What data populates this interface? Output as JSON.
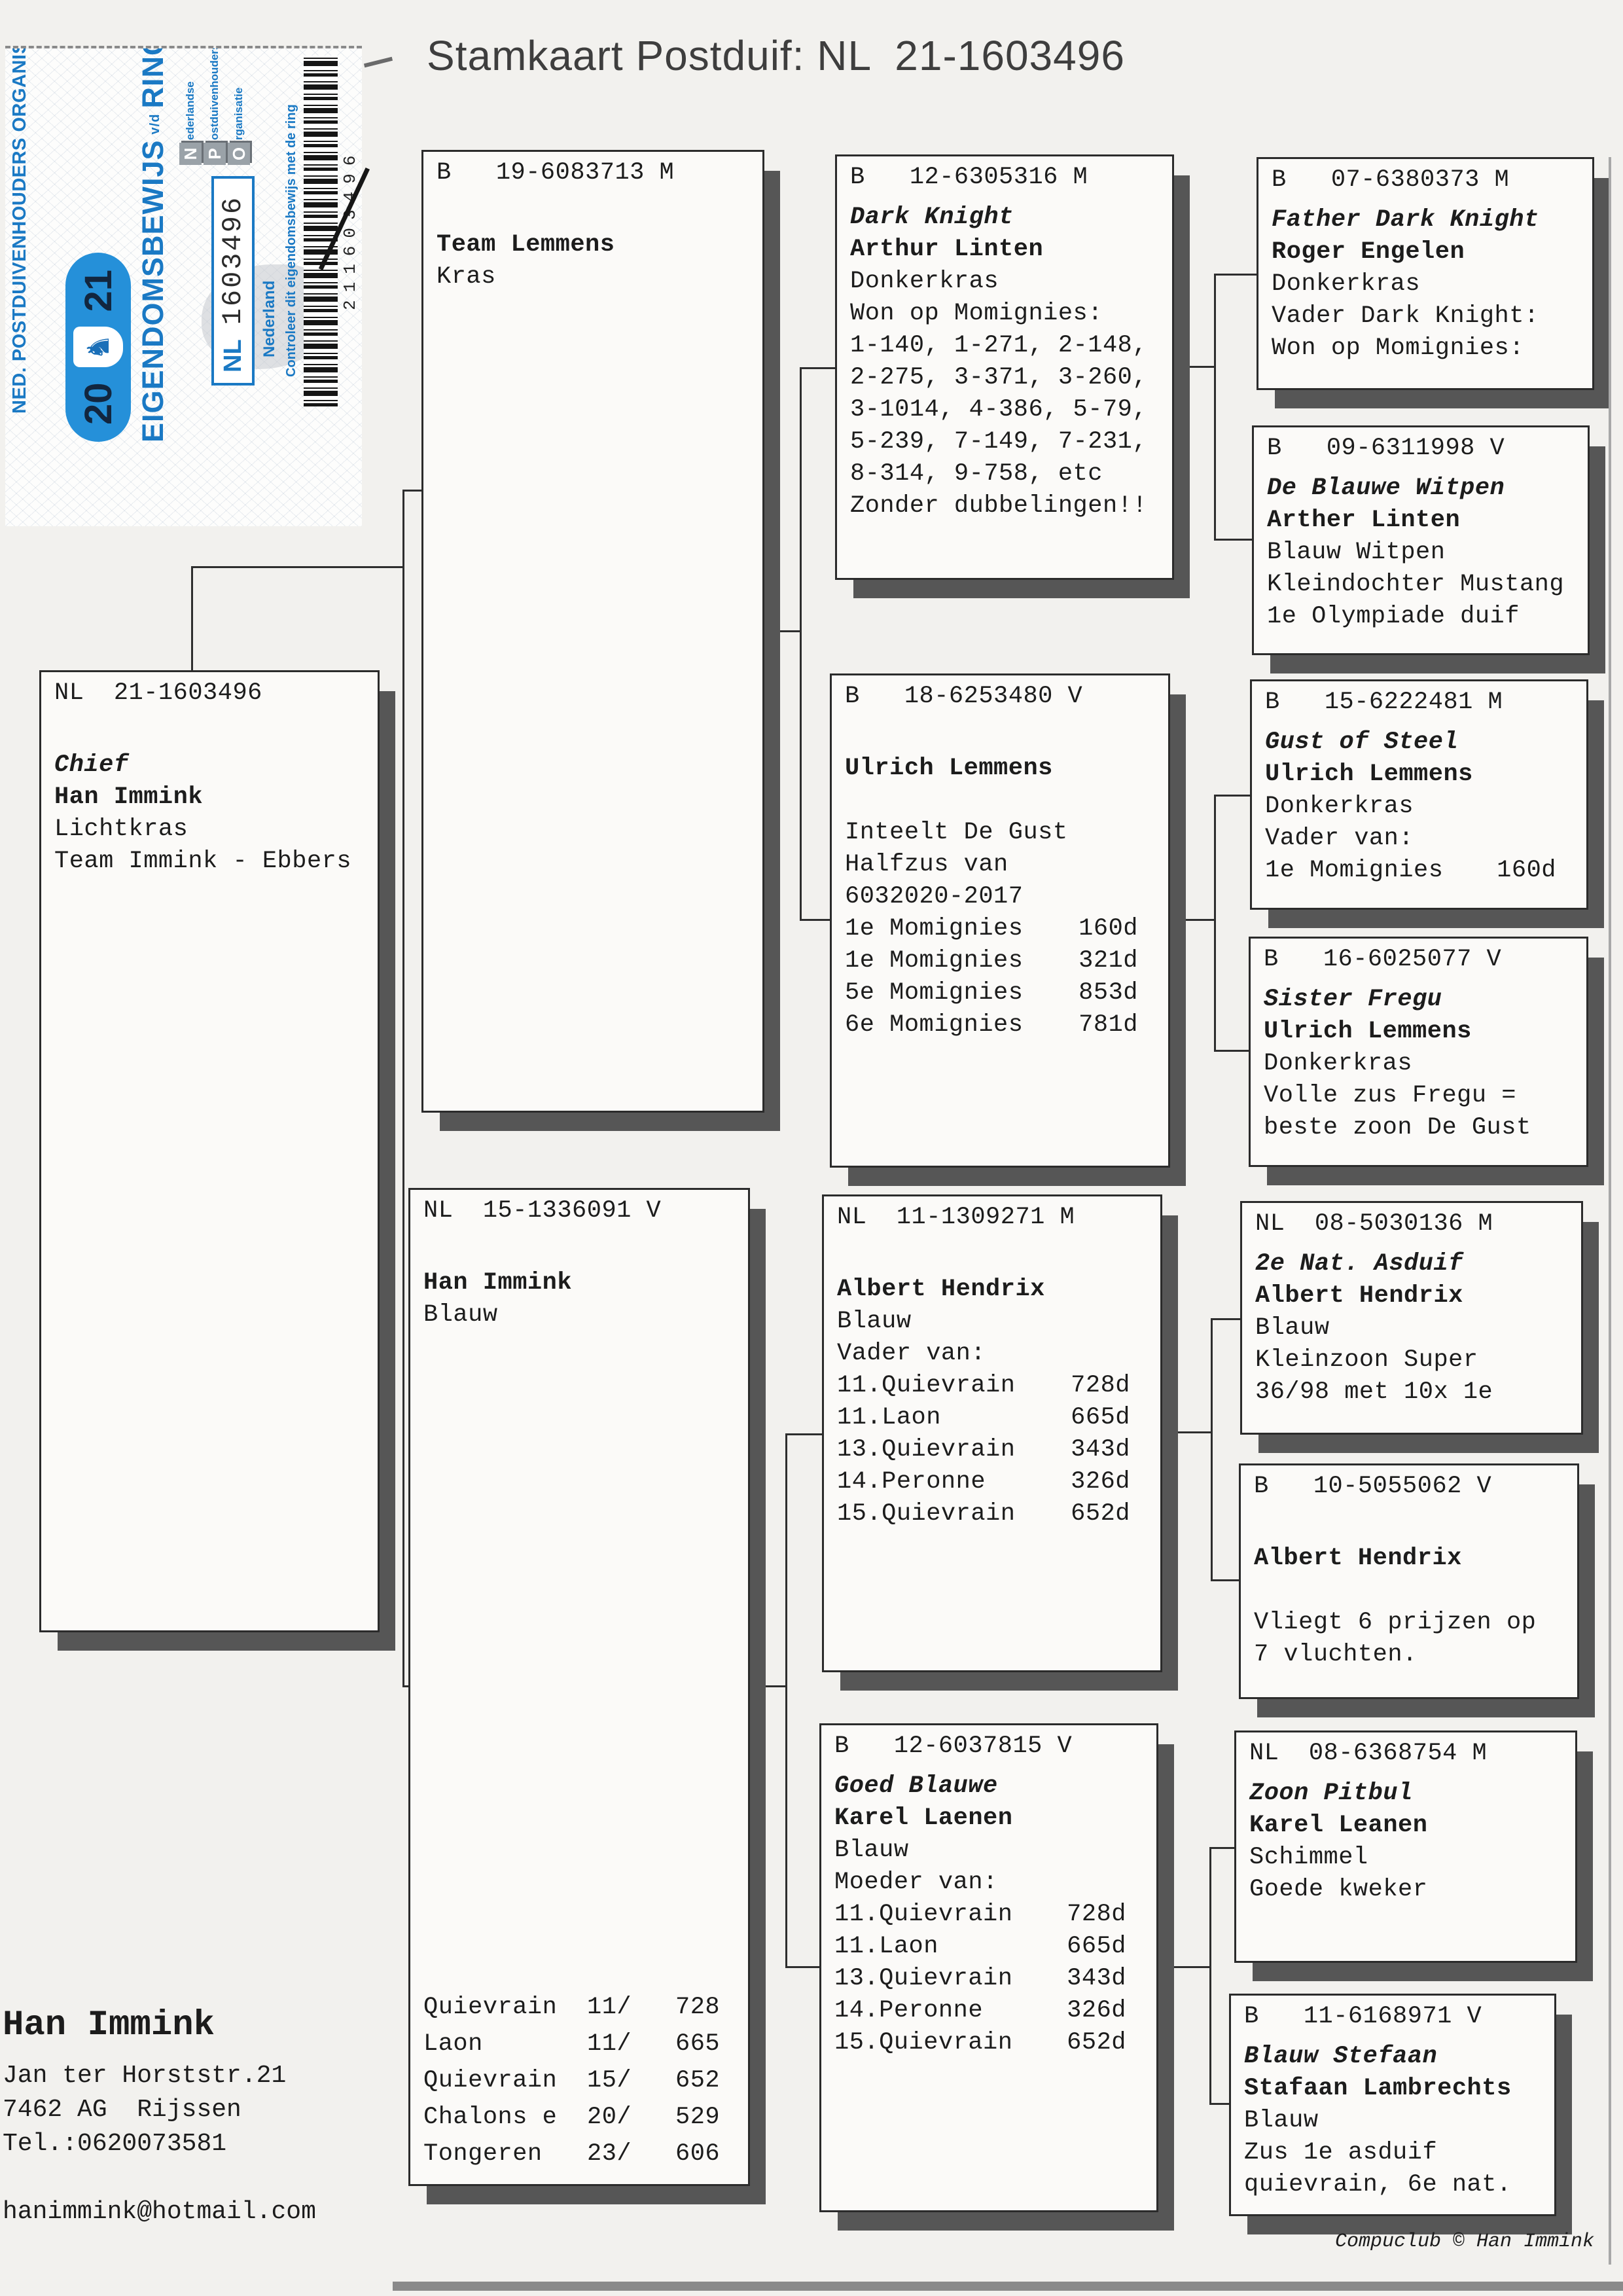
{
  "title": "Stamkaart Postduif: NL  21-1603496",
  "colors": {
    "sticker_blue": "#1a79c4",
    "pill_blue": "#2590d9",
    "box_shadow_gray": "#565656",
    "paper": "#f2f1ee"
  },
  "sticker": {
    "org_line": "NED. POSTDUIVENHOUDERS ORGANISATIE",
    "year_left": "20",
    "year_right": "21",
    "doc_title_main": "EIGENDOMSBEWIJS",
    "doc_title_small": "v/d",
    "doc_title_end": "RING",
    "npo": [
      {
        "big": "N",
        "rest": "ederlandse"
      },
      {
        "big": "P",
        "rest": "ostduivenhouders"
      },
      {
        "big": "O",
        "rest": "rganisatie"
      }
    ],
    "ring_country": "NL",
    "ring_number": "1603496",
    "country_label": "Nederland",
    "check_line": "Controleer dit eigendomsbewijs met de ring",
    "barcode_number": "211603496"
  },
  "boxes": {
    "chief": {
      "reg": "NL  21-1603496",
      "lines": [
        {
          "t": ""
        },
        {
          "t": "Chief",
          "s": "bi"
        },
        {
          "t": "Han Immink",
          "s": "b"
        },
        {
          "t": "Lichtkras"
        },
        {
          "t": "Team Immink - Ebbers"
        }
      ]
    },
    "b19": {
      "reg": "B   19-6083713 M",
      "lines": [
        {
          "t": ""
        },
        {
          "t": "Team Lemmens",
          "s": "b"
        },
        {
          "t": "Kras"
        }
      ]
    },
    "nl15": {
      "reg": "NL  15-1336091 V",
      "lines": [
        {
          "t": ""
        },
        {
          "t": "Han Immink",
          "s": "b"
        },
        {
          "t": "Blauw"
        }
      ],
      "footer_rows": [
        [
          "Quievrain",
          "11/",
          "728"
        ],
        [
          "Laon",
          "11/",
          "665"
        ],
        [
          "Quievrain",
          "15/",
          "652"
        ],
        [
          "Chalons e",
          "20/",
          "529"
        ],
        [
          "Tongeren",
          "23/",
          "606"
        ]
      ]
    },
    "dk": {
      "reg": "B   12-6305316 M",
      "lines": [
        {
          "t": "Dark Knight",
          "s": "bi"
        },
        {
          "t": "Arthur Linten",
          "s": "b"
        },
        {
          "t": "Donkerkras"
        },
        {
          "t": "Won op Momignies:"
        },
        {
          "t": "1-140, 1-271, 2-148,"
        },
        {
          "t": "2-275, 3-371, 3-260,"
        },
        {
          "t": "3-1014, 4-386, 5-79,"
        },
        {
          "t": "5-239, 7-149, 7-231,"
        },
        {
          "t": "8-314, 9-758, etc"
        },
        {
          "t": "Zonder dubbelingen!!"
        }
      ]
    },
    "b18": {
      "reg": "B   18-6253480 V",
      "lines": [
        {
          "t": ""
        },
        {
          "t": "Ulrich Lemmens",
          "s": "b"
        },
        {
          "t": ""
        },
        {
          "t": "Inteelt De Gust"
        },
        {
          "t": "Halfzus van"
        },
        {
          "t": "6032020-2017"
        },
        {
          "t": "1e Momignies",
          "r": "160d"
        },
        {
          "t": "1e Momignies",
          "r": "321d"
        },
        {
          "t": "5e Momignies",
          "r": "853d"
        },
        {
          "t": "6e Momignies",
          "r": "781d"
        }
      ]
    },
    "nl11": {
      "reg": "NL  11-1309271 M",
      "lines": [
        {
          "t": ""
        },
        {
          "t": "Albert Hendrix",
          "s": "b"
        },
        {
          "t": "Blauw"
        },
        {
          "t": "Vader van:"
        },
        {
          "t": "11.Quievrain",
          "r": "728d"
        },
        {
          "t": "11.Laon",
          "r": "665d"
        },
        {
          "t": "13.Quievrain",
          "r": "343d"
        },
        {
          "t": "14.Peronne",
          "r": "326d"
        },
        {
          "t": "15.Quievrain",
          "r": "652d"
        }
      ]
    },
    "goed": {
      "reg": "B   12-6037815 V",
      "lines": [
        {
          "t": "Goed Blauwe",
          "s": "bi"
        },
        {
          "t": "Karel Laenen",
          "s": "b"
        },
        {
          "t": "Blauw"
        },
        {
          "t": "Moeder van:"
        },
        {
          "t": "11.Quievrain",
          "r": "728d"
        },
        {
          "t": "11.Laon",
          "r": "665d"
        },
        {
          "t": "13.Quievrain",
          "r": "343d"
        },
        {
          "t": "14.Peronne",
          "r": "326d"
        },
        {
          "t": "15.Quievrain",
          "r": "652d"
        }
      ]
    },
    "b07": {
      "reg": "B   07-6380373 M",
      "lines": [
        {
          "t": "Father Dark Knight",
          "s": "bi"
        },
        {
          "t": "Roger Engelen",
          "s": "b"
        },
        {
          "t": "Donkerkras"
        },
        {
          "t": "Vader Dark Knight:"
        },
        {
          "t": "Won op Momignies:"
        }
      ]
    },
    "b09": {
      "reg": "B   09-6311998 V",
      "lines": [
        {
          "t": "De Blauwe Witpen",
          "s": "bi"
        },
        {
          "t": "Arther Linten",
          "s": "b"
        },
        {
          "t": "Blauw Witpen"
        },
        {
          "t": "Kleindochter Mustang"
        },
        {
          "t": "1e Olympiade duif"
        }
      ]
    },
    "b15": {
      "reg": "B   15-6222481 M",
      "lines": [
        {
          "t": "Gust of Steel",
          "s": "bi"
        },
        {
          "t": "Ulrich Lemmens",
          "s": "b"
        },
        {
          "t": "Donkerkras"
        },
        {
          "t": "Vader van:"
        },
        {
          "t": "1e Momignies",
          "r": "160d"
        }
      ]
    },
    "b16": {
      "reg": "B   16-6025077 V",
      "lines": [
        {
          "t": "Sister Fregu",
          "s": "bi"
        },
        {
          "t": "Ulrich Lemmens",
          "s": "b"
        },
        {
          "t": "Donkerkras"
        },
        {
          "t": "Volle zus Fregu ="
        },
        {
          "t": "beste zoon De Gust"
        }
      ]
    },
    "nl08a": {
      "reg": "NL  08-5030136 M",
      "lines": [
        {
          "t": "2e Nat. Asduif",
          "s": "bi"
        },
        {
          "t": "Albert Hendrix",
          "s": "b"
        },
        {
          "t": "Blauw"
        },
        {
          "t": "Kleinzoon Super"
        },
        {
          "t": "36/98 met 10x 1e"
        }
      ]
    },
    "b10": {
      "reg": "B   10-5055062 V",
      "lines": [
        {
          "t": ""
        },
        {
          "t": "Albert Hendrix",
          "s": "b"
        },
        {
          "t": ""
        },
        {
          "t": "Vliegt 6 prijzen op"
        },
        {
          "t": "7 vluchten."
        }
      ]
    },
    "nl08b": {
      "reg": "NL  08-6368754 M",
      "lines": [
        {
          "t": "Zoon Pitbul",
          "s": "bi"
        },
        {
          "t": "Karel Leanen",
          "s": "b"
        },
        {
          "t": "Schimmel"
        },
        {
          "t": "Goede kweker"
        }
      ]
    },
    "b11": {
      "reg": "B   11-6168971 V",
      "lines": [
        {
          "t": "Blauw Stefaan",
          "s": "bi"
        },
        {
          "t": "Stafaan Lambrechts",
          "s": "b"
        },
        {
          "t": "Blauw"
        },
        {
          "t": "Zus 1e asduif"
        },
        {
          "t": "quievrain, 6e nat."
        }
      ]
    }
  },
  "owner": {
    "name": "Han Immink",
    "street": "Jan ter Horststr.21",
    "city": "7462 AG  Rijssen",
    "tel": "Tel.:0620073581",
    "email": "hanimmink@hotmail.com"
  },
  "footer": {
    "credit": "Compuclub © Han Immink"
  }
}
